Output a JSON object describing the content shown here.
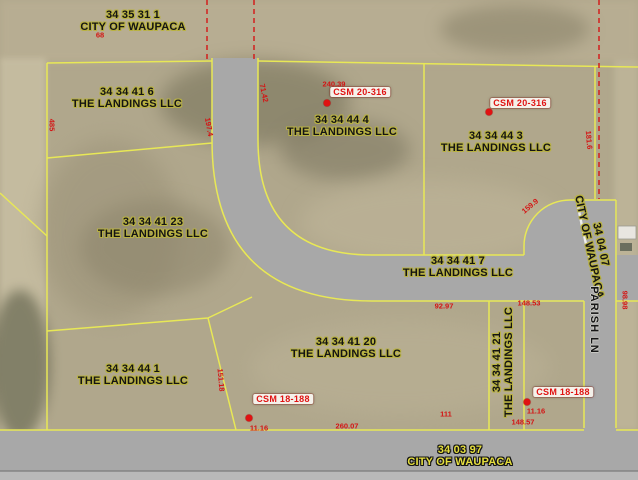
{
  "title": "Parcel map - The Landings / City of Waupaca",
  "colors": {
    "parcel_line_yellow": "#e8e856",
    "road_gray": "#a8a8a8",
    "road_shoulder_gray": "#b9b9b9",
    "annotation_red": "#d41414",
    "csm_red": "#e01212",
    "csm_background": "#f4f1ea",
    "label_dark": "#141414",
    "label_outline_olive": "#b9b242",
    "label_yellow": "#e6df3e",
    "aerial_base": "#b0a78c"
  },
  "parcel_labels": [
    {
      "line1": "34 35 31 1",
      "line2": "CITY OF WAUPACA",
      "x": 133,
      "y": 22,
      "rot": 0,
      "style": "dark"
    },
    {
      "line1": "34 34 41 6",
      "line2": "THE LANDINGS LLC",
      "x": 127,
      "y": 99,
      "rot": 0,
      "style": "dark"
    },
    {
      "line1": "34 34 44 4",
      "line2": "THE LANDINGS LLC",
      "x": 342,
      "y": 127,
      "rot": 0,
      "style": "dark"
    },
    {
      "line1": "34 34 44 3",
      "line2": "THE LANDINGS LLC",
      "x": 496,
      "y": 143,
      "rot": 0,
      "style": "dark"
    },
    {
      "line1": "34 34 41 23",
      "line2": "THE LANDINGS LLC",
      "x": 153,
      "y": 229,
      "rot": 0,
      "style": "dark"
    },
    {
      "line1": "34 34 41 7",
      "line2": "THE LANDINGS LLC",
      "x": 458,
      "y": 268,
      "rot": 0,
      "style": "dark"
    },
    {
      "line1": "34 34 41 20",
      "line2": "THE LANDINGS LLC",
      "x": 346,
      "y": 349,
      "rot": 0,
      "style": "dark"
    },
    {
      "line1": "34 34 41 21",
      "line2": "THE LANDINGS LLC",
      "x": 504,
      "y": 362,
      "rot": -90,
      "style": "dark"
    },
    {
      "line1": "34 34 44 1",
      "line2": "THE LANDINGS LLC",
      "x": 133,
      "y": 376,
      "rot": 0,
      "style": "dark"
    },
    {
      "line1": "34 03 97",
      "line2": "CITY OF WAUPACA",
      "x": 460,
      "y": 457,
      "rot": 0,
      "style": "yellow"
    },
    {
      "line1": "34 04 07",
      "line2": "CITY OF WAUPACA",
      "x": 594,
      "y": 246,
      "rot": 78,
      "style": "dark"
    }
  ],
  "road_labels": [
    {
      "text": "PARISH LN",
      "x": 594,
      "y": 320,
      "rot": 90
    }
  ],
  "csm_labels": [
    {
      "text": "CSM 20-316",
      "x": 360,
      "y": 92,
      "dot_x": 327,
      "dot_y": 103
    },
    {
      "text": "CSM 20-316",
      "x": 520,
      "y": 103,
      "dot_x": 489,
      "dot_y": 112
    },
    {
      "text": "CSM 18-188",
      "x": 283,
      "y": 399,
      "dot_x": 249,
      "dot_y": 418
    },
    {
      "text": "CSM 18-188",
      "x": 563,
      "y": 392,
      "dot_x": 527,
      "dot_y": 402
    }
  ],
  "dimension_labels": [
    {
      "text": "68",
      "x": 100,
      "y": 35,
      "rot": 0
    },
    {
      "text": "240.39",
      "x": 334,
      "y": 84,
      "rot": 0
    },
    {
      "text": "71.42",
      "x": 264,
      "y": 93,
      "rot": 78
    },
    {
      "text": "197.4",
      "x": 209,
      "y": 127,
      "rot": 80
    },
    {
      "text": "485",
      "x": 52,
      "y": 125,
      "rot": 90
    },
    {
      "text": "181.6",
      "x": 589,
      "y": 140,
      "rot": 85
    },
    {
      "text": "159.9",
      "x": 530,
      "y": 206,
      "rot": -40
    },
    {
      "text": "92.97",
      "x": 444,
      "y": 306,
      "rot": 0
    },
    {
      "text": "148.53",
      "x": 529,
      "y": 303,
      "rot": 0
    },
    {
      "text": "98.98",
      "x": 625,
      "y": 300,
      "rot": 90
    },
    {
      "text": "151.18",
      "x": 221,
      "y": 380,
      "rot": 85
    },
    {
      "text": "11.16",
      "x": 259,
      "y": 428,
      "rot": 0
    },
    {
      "text": "11.16",
      "x": 536,
      "y": 411,
      "rot": 0
    },
    {
      "text": "260.07",
      "x": 347,
      "y": 426,
      "rot": 0
    },
    {
      "text": "111",
      "x": 446,
      "y": 414,
      "rot": 0
    },
    {
      "text": "148.57",
      "x": 523,
      "y": 422,
      "rot": 0
    }
  ]
}
